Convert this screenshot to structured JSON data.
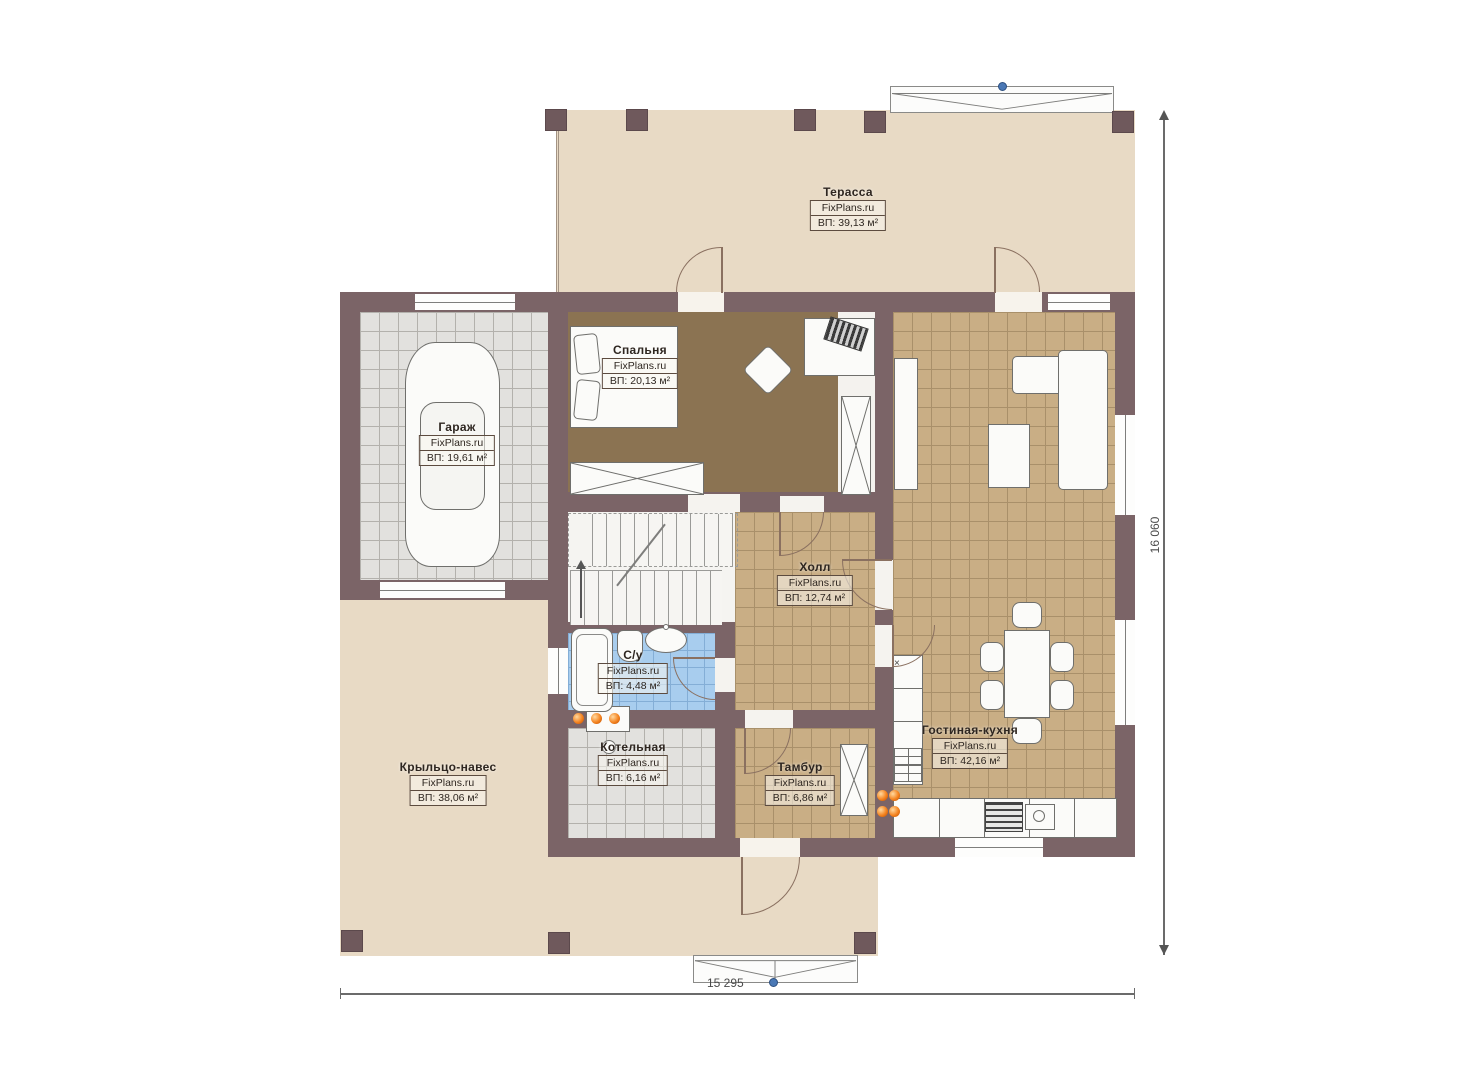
{
  "plan": {
    "brand": "FixPlans.ru",
    "dim_bottom": "15 295",
    "dim_right": "16 060",
    "marks": {
      "kitchen_cross": "×"
    },
    "colors": {
      "wall": "#7b6467",
      "terrace_floor": "#e8dac5",
      "tile_tan": "#c9ae85",
      "carpet_brown": "#8b7352",
      "tile_blue": "#a8cdee",
      "tile_gray": "#e2e1de",
      "burner_orange": "#f4831f",
      "marker_blue": "#4a78b5"
    },
    "rooms": [
      {
        "id": "terrace",
        "name": "Терасса",
        "area": "ВП: 39,13 м²"
      },
      {
        "id": "bedroom",
        "name": "Спальня",
        "area": "ВП: 20,13 м²"
      },
      {
        "id": "garage",
        "name": "Гараж",
        "area": "ВП: 19,61 м²"
      },
      {
        "id": "hall",
        "name": "Холл",
        "area": "ВП: 12,74 м²"
      },
      {
        "id": "bathroom",
        "name": "С/у",
        "area": "ВП: 4,48 м²"
      },
      {
        "id": "boiler",
        "name": "Котельная",
        "area": "ВП: 6,16 м²"
      },
      {
        "id": "tambour",
        "name": "Тамбур",
        "area": "ВП: 6,86 м²"
      },
      {
        "id": "living_kitchen",
        "name": "Гостиная-кухня",
        "area": "ВП: 42,16 м²"
      },
      {
        "id": "porch",
        "name": "Крыльцо-навес",
        "area": "ВП: 38,06 м²"
      }
    ]
  }
}
